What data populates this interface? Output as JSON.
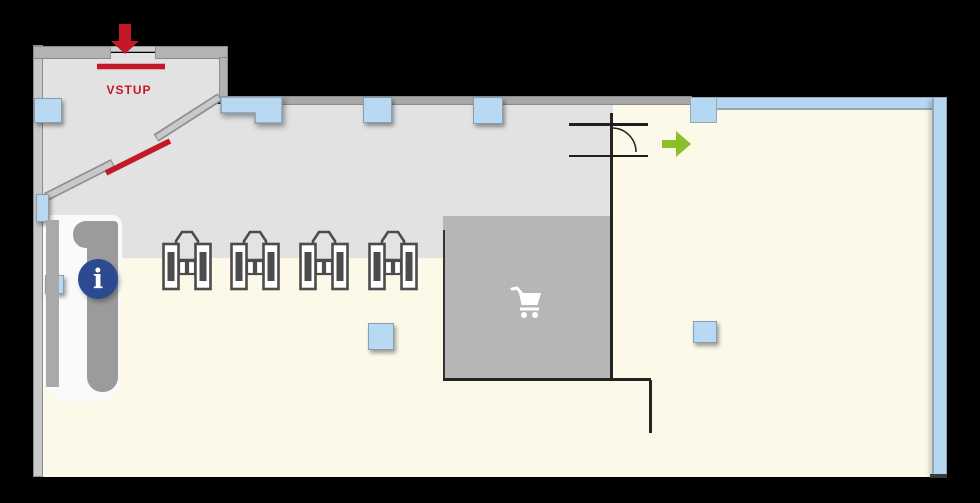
{
  "floorplan": {
    "type": "store-entrance-plan",
    "entrance": {
      "label": "VSTUP",
      "arrow_direction": "down",
      "door_marks": "red"
    },
    "info_point": {
      "glyph": "i"
    },
    "icons": {
      "entry_arrow": "red-down-arrow-icon",
      "flow_arrow": "green-right-arrow-icon",
      "cart_zone": "shopping-cart-icon",
      "info": "info-icon",
      "turnstile_count": 4,
      "door_swing": "door-arc-symbol"
    },
    "colors": {
      "background": "#000000",
      "sales_floor": "#fcf9e9",
      "entry_zone": "#e2e2e2",
      "cart_zone": "#b6b6b6",
      "walls": "#a8a8a8",
      "glass_band": "#b5d8f2",
      "accent_red": "#c41727",
      "accent_green": "#8cbe2a",
      "info_blue": "#2b4a90"
    }
  }
}
